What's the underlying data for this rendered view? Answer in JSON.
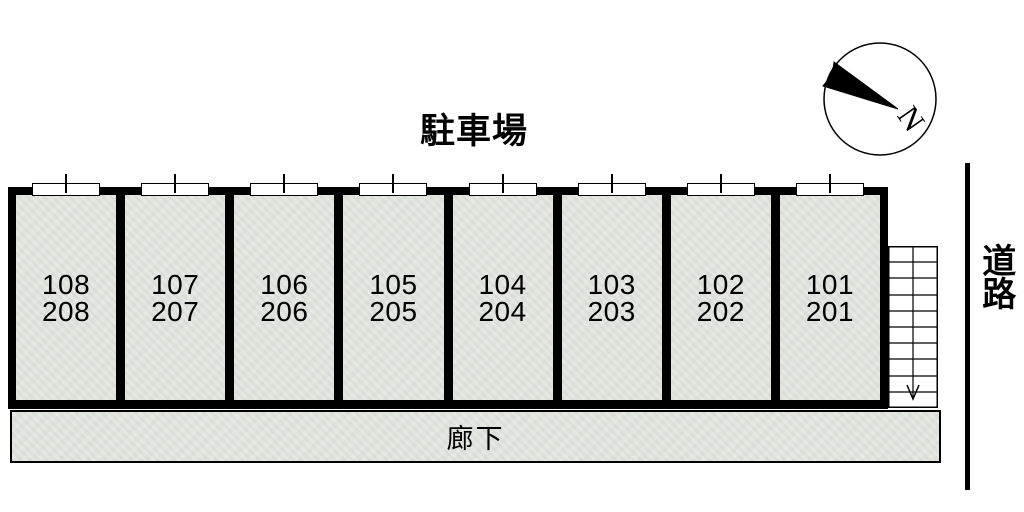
{
  "title": "駐車場",
  "building": {
    "units": [
      {
        "room_upper": "108",
        "room_lower": "208"
      },
      {
        "room_upper": "107",
        "room_lower": "207"
      },
      {
        "room_upper": "106",
        "room_lower": "206"
      },
      {
        "room_upper": "105",
        "room_lower": "205"
      },
      {
        "room_upper": "104",
        "room_lower": "204"
      },
      {
        "room_upper": "103",
        "room_lower": "203"
      },
      {
        "room_upper": "102",
        "room_lower": "202"
      },
      {
        "room_upper": "101",
        "room_lower": "201"
      }
    ]
  },
  "corridor": {
    "label": "廊下"
  },
  "road": {
    "label": "道路"
  },
  "compass": {
    "label": "N"
  },
  "colors": {
    "wall": "#000000",
    "floor_fill": "#e4e6e1",
    "background": "#ffffff"
  }
}
